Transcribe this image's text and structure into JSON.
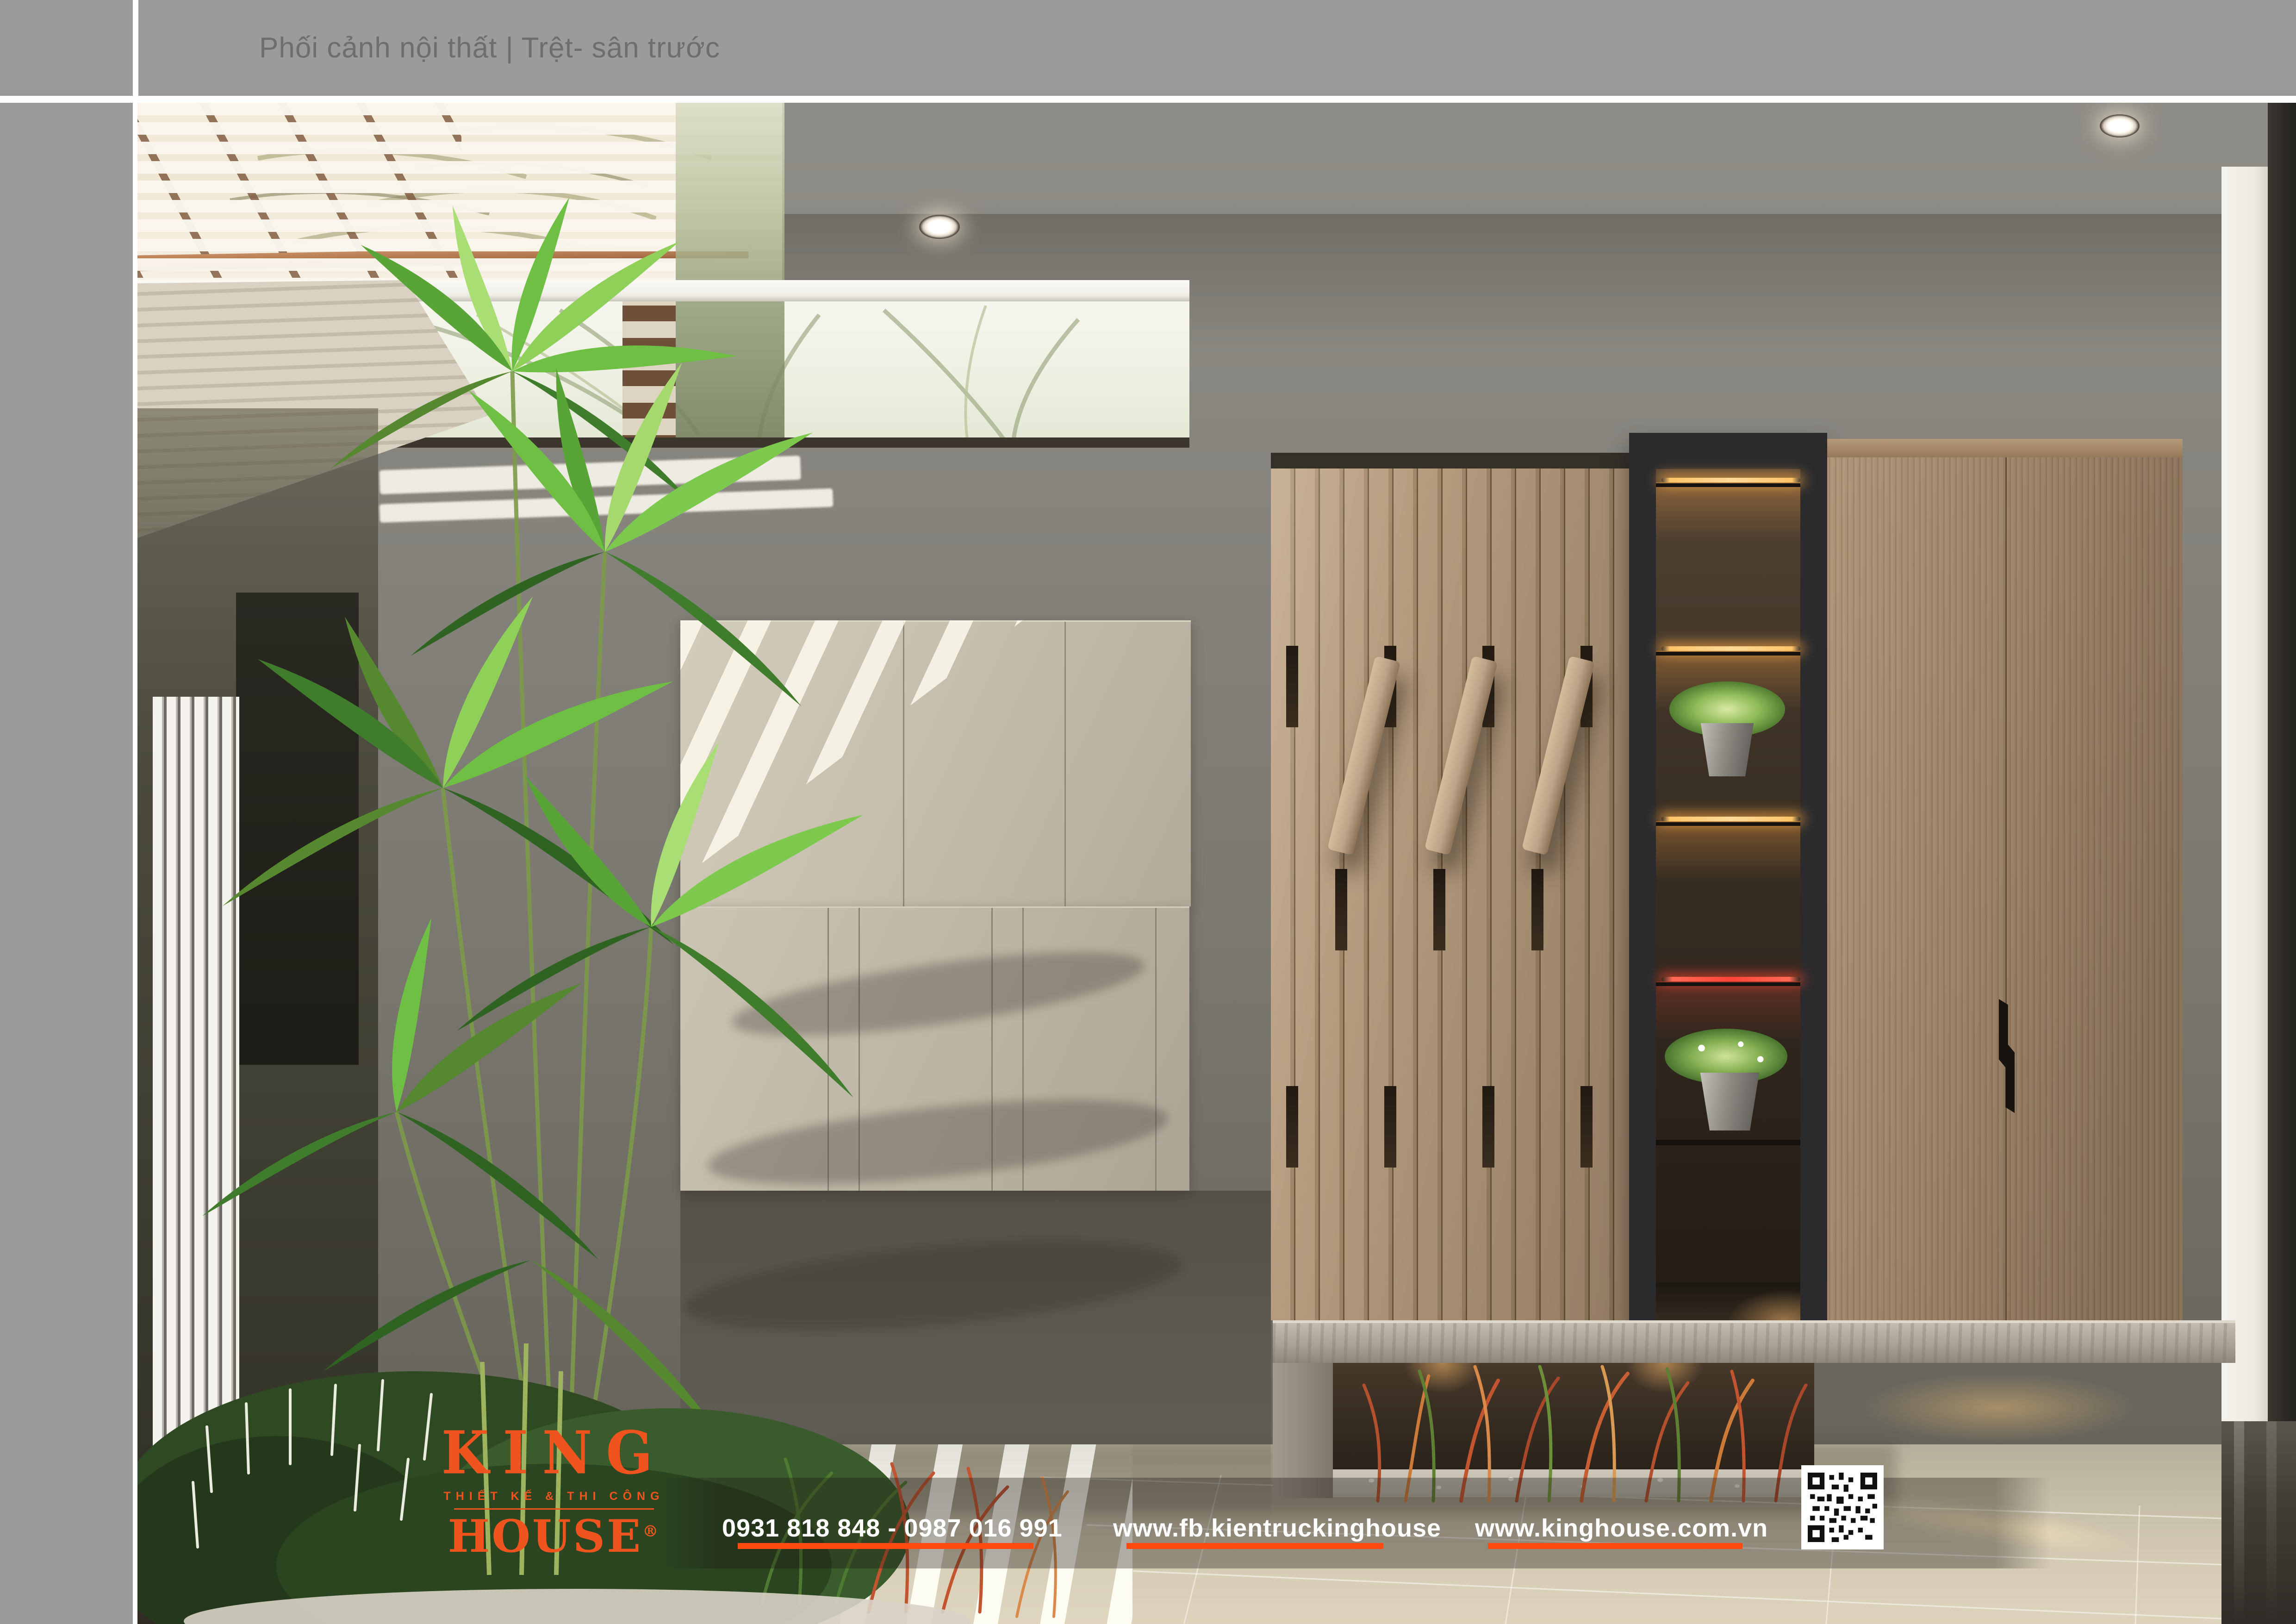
{
  "header": {
    "title": "Phối cảnh nội thất | Trệt- sân trước"
  },
  "footer": {
    "logo": {
      "brand_top": "KING",
      "tagline": "THIẾT KẾ & THI CÔNG",
      "brand": "HOUSE",
      "registered": "®"
    },
    "phone": "0931 818 848 - 0987 016 991",
    "facebook": "www.fb.kientruckinghouse",
    "website": "www.kinghouse.com.vn"
  },
  "colors": {
    "accent_orange": "#ff4b12",
    "logo_orange": "#f0541e",
    "header_gray": "#9b9b9b",
    "title_gray": "#6e6e6c",
    "ceiling_wood_dark": "#4a3e33",
    "ceiling_wood_light": "#9a7d5e",
    "wall_gray": "#84827b",
    "cabinet_beige": "#c6bfae",
    "slat_wood": "#b69c7f",
    "wardrobe_wood": "#9d8266",
    "led_amber": "#ffc468",
    "led_red": "#ff4438",
    "floor_beige": "#cfc6b0"
  }
}
